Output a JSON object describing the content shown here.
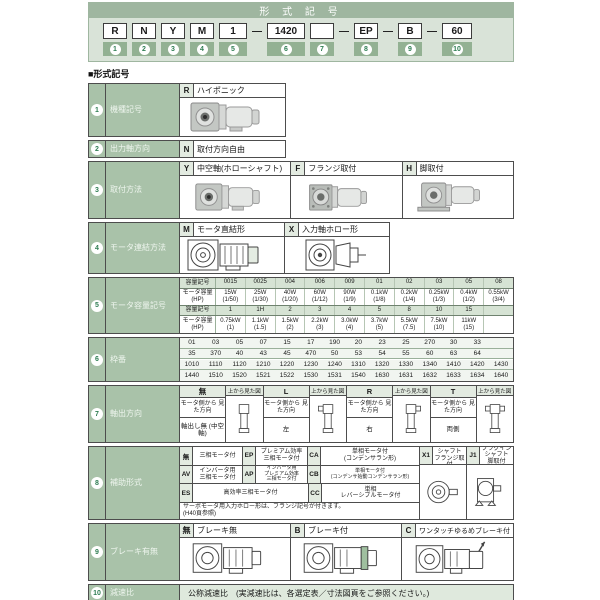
{
  "header": {
    "title": "形 式 記 号",
    "dash": "—",
    "boxes": {
      "b1": {
        "label": "R",
        "num": "1"
      },
      "b2": {
        "label": "N",
        "num": "2"
      },
      "b3": {
        "label": "Y",
        "num": "3"
      },
      "b4": {
        "label": "M",
        "num": "4"
      },
      "b5": {
        "label": "1",
        "num": "5"
      },
      "b6": {
        "label": "1420",
        "num": "6"
      },
      "b7": {
        "label": "",
        "num": "7"
      },
      "b8": {
        "label": "EP",
        "num": "8"
      },
      "b9": {
        "label": "B",
        "num": "9"
      },
      "b10": {
        "label": "60",
        "num": "10"
      }
    }
  },
  "section_title": "■形式記号",
  "row_meta": {
    "r1": {
      "num": "1",
      "label": "機種記号"
    },
    "r2": {
      "num": "2",
      "label": "出力軸方向"
    },
    "r3": {
      "num": "3",
      "label": "取付方法"
    },
    "r4": {
      "num": "4",
      "label": "モータ連結方法"
    },
    "r5": {
      "num": "5",
      "label": "モータ容量記号"
    },
    "r6": {
      "num": "6",
      "label": "枠番"
    },
    "r7": {
      "num": "7",
      "label": "軸出方向"
    },
    "r8": {
      "num": "8",
      "label": "補助形式"
    },
    "r9": {
      "num": "9",
      "label": "ブレーキ有無"
    },
    "r10": {
      "num": "10",
      "label": "減速比"
    }
  },
  "r1": {
    "code": "R",
    "name": "ハイポニック"
  },
  "r2": {
    "code": "N",
    "name": "取付方向自由"
  },
  "r3": {
    "opts": [
      {
        "code": "Y",
        "name": "中空軸(ホローシャフト)"
      },
      {
        "code": "F",
        "name": "フランジ取付"
      },
      {
        "code": "H",
        "name": "脚取付"
      }
    ]
  },
  "r4": {
    "opts": [
      {
        "code": "M",
        "name": "モータ直結形"
      },
      {
        "code": "X",
        "name": "入力軸ホロー形"
      }
    ]
  },
  "r5": {
    "hdr_code": "容量記号",
    "hdr_power": "モータ容量\n(HP)",
    "codes1": [
      "0015",
      "0025",
      "004",
      "006",
      "009",
      "01",
      "02",
      "03",
      "05",
      "08"
    ],
    "powers1": [
      "15W\n(1/50)",
      "25W\n(1/30)",
      "40W\n(1/20)",
      "60W\n(1/12)",
      "90W\n(1/9)",
      "0.1kW\n(1/8)",
      "0.2kW\n(1/4)",
      "0.25kW\n(1/3)",
      "0.4kW\n(1/2)",
      "0.55kW\n(3/4)"
    ],
    "codes2": [
      "1",
      "1H",
      "2",
      "3",
      "4",
      "5",
      "8",
      "10",
      "15",
      ""
    ],
    "powers2": [
      "0.75kW\n(1)",
      "1.1kW\n(1.5)",
      "1.5kW\n(2)",
      "2.2kW\n(3)",
      "3.0kW\n(4)",
      "3.7kW\n(5)",
      "5.5kW\n(7.5)",
      "7.5kW\n(10)",
      "11kW\n(15)",
      ""
    ]
  },
  "r6": {
    "rows": [
      [
        "01",
        "03",
        "05",
        "07",
        "15",
        "17",
        "190",
        "20",
        "23",
        "25",
        "270",
        "30",
        "33",
        ""
      ],
      [
        "35",
        "370",
        "40",
        "43",
        "45",
        "470",
        "50",
        "53",
        "54",
        "55",
        "60",
        "63",
        "64",
        ""
      ],
      [
        "1010",
        "1110",
        "1120",
        "1210",
        "1220",
        "1230",
        "1240",
        "1310",
        "1320",
        "1330",
        "1340",
        "1410",
        "1420",
        "1430"
      ],
      [
        "1440",
        "1510",
        "1520",
        "1521",
        "1522",
        "1530",
        "1531",
        "1540",
        "1630",
        "1631",
        "1632",
        "1633",
        "1634",
        "1640"
      ]
    ]
  },
  "r7": {
    "view_from_top": "上から見た図",
    "seen_from_motor": "モータ側から\n見た方向",
    "groups": [
      {
        "code": "無",
        "dir": "軸出し無\n(中空軸)"
      },
      {
        "code": "L",
        "dir": "左"
      },
      {
        "code": "R",
        "dir": "右"
      },
      {
        "code": "T",
        "dir": "両側"
      }
    ]
  },
  "r8": {
    "cells": {
      "none": {
        "code": "無",
        "name": "三相モータ付"
      },
      "ep": {
        "code": "EP",
        "name": "プレミアム効率\n三相モータ付"
      },
      "ca": {
        "code": "CA",
        "name": "単相モータ付\n(コンデンサラン形)"
      },
      "av": {
        "code": "AV",
        "name": "インバータ用\n三相モータ付"
      },
      "ap": {
        "code": "AP",
        "name": "インバータ用\nプレミアム効率\n三相モータ付"
      },
      "cb": {
        "code": "CB",
        "name": "単相モータ付\n(コンデンサ始動コンデンサラン形)"
      },
      "es": {
        "code": "ES",
        "name": "高効率三相モータ付"
      },
      "cc": {
        "code": "CC",
        "name": "単相\nレバーシブルモータ付"
      },
      "x1": {
        "code": "X1",
        "name": "プラグインシャフト\nフランジ取付"
      },
      "j1": {
        "code": "J1",
        "name": "プラグインシャフト\n脚取付"
      }
    },
    "note": "サーボモータ用入力ホロー形は、フランジ記号が付きます。\n(H40頁参照)"
  },
  "r9": {
    "opts": [
      {
        "code": "無",
        "name": "ブレーキ無"
      },
      {
        "code": "B",
        "name": "ブレーキ付"
      },
      {
        "code": "C",
        "name": "ワンタッチゆるめブレーキ付"
      }
    ]
  },
  "r10": {
    "text": "公称減速比　(実減速比は、各選定表／寸法図頁をご参照ください。)"
  }
}
